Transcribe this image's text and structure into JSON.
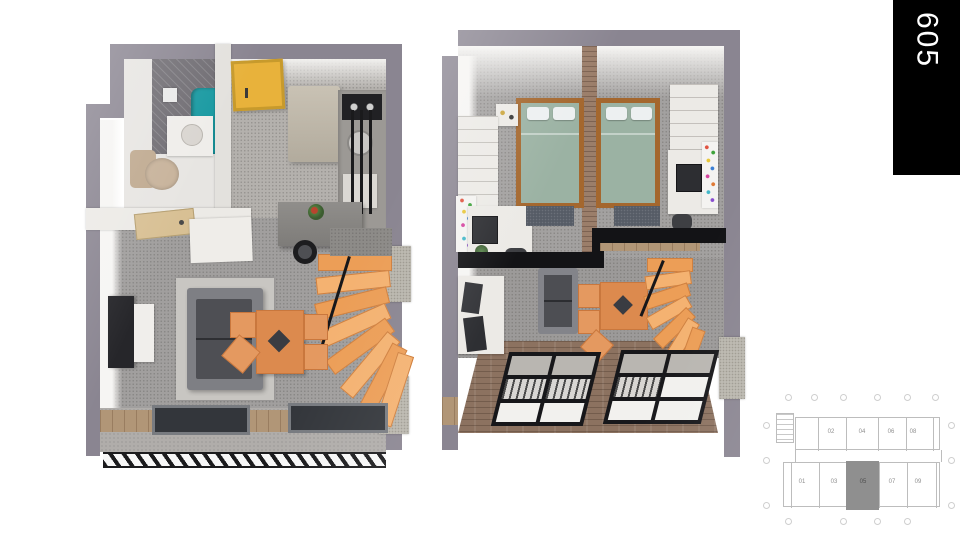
{
  "banner": {
    "unit_number": "605",
    "bg": "#000000",
    "text_color": "#ffffff"
  },
  "key_plan": {
    "highlighted_unit": "05",
    "units_top_row": [
      "02",
      "04",
      "06",
      "08"
    ],
    "units_bottom_row": [
      "01",
      "03",
      "05",
      "07",
      "09"
    ],
    "highlight_color": "#8f8f8f",
    "line_color": "#bdbdbd"
  },
  "plans": {
    "lower_floor": {
      "elements": [
        "shower",
        "shower-curtain",
        "toilet",
        "sink",
        "entry-door-yellow",
        "interior-door",
        "refrigerator",
        "kitchen-counter",
        "cooktop",
        "kitchen-sink",
        "wall-shelf",
        "island-counter",
        "bar-stools",
        "flower-pot",
        "winder-stairs",
        "stair-railing",
        "sofa",
        "area-rug",
        "tv",
        "tv-console",
        "dining-table",
        "dining-chairs",
        "balcony-bench",
        "balcony-planters",
        "balcony-railing"
      ]
    },
    "upper_floor": {
      "elements": [
        "bed-1",
        "bed-2",
        "brick-partition",
        "headboard-shelf",
        "wardrobe-left",
        "wardrobe-right",
        "desk-left",
        "desk-right",
        "monitor",
        "pinboard",
        "sticky-notes",
        "bedside-rugs",
        "mezzanine-edge",
        "void-sideboard",
        "picture-frames",
        "void-sofa",
        "void-dining-table",
        "winder-stairs",
        "brick-floor",
        "facade-windows"
      ]
    }
  },
  "colors": {
    "wall_gray": "#8a8591",
    "carpet_gray": "#a19f9e",
    "concrete": "#b4b1ad",
    "stair_orange": "#ec9e57",
    "furniture_orange": "#dc8a4e",
    "bedding_green": "#9bb2a3",
    "bed_frame_wood": "#a4672e",
    "door_yellow": "#e8b23b",
    "shower_teal": "#1899a1",
    "sofa_dark": "#4e4f54",
    "brick": "#8c7260",
    "wood_sill": "#b19677"
  }
}
